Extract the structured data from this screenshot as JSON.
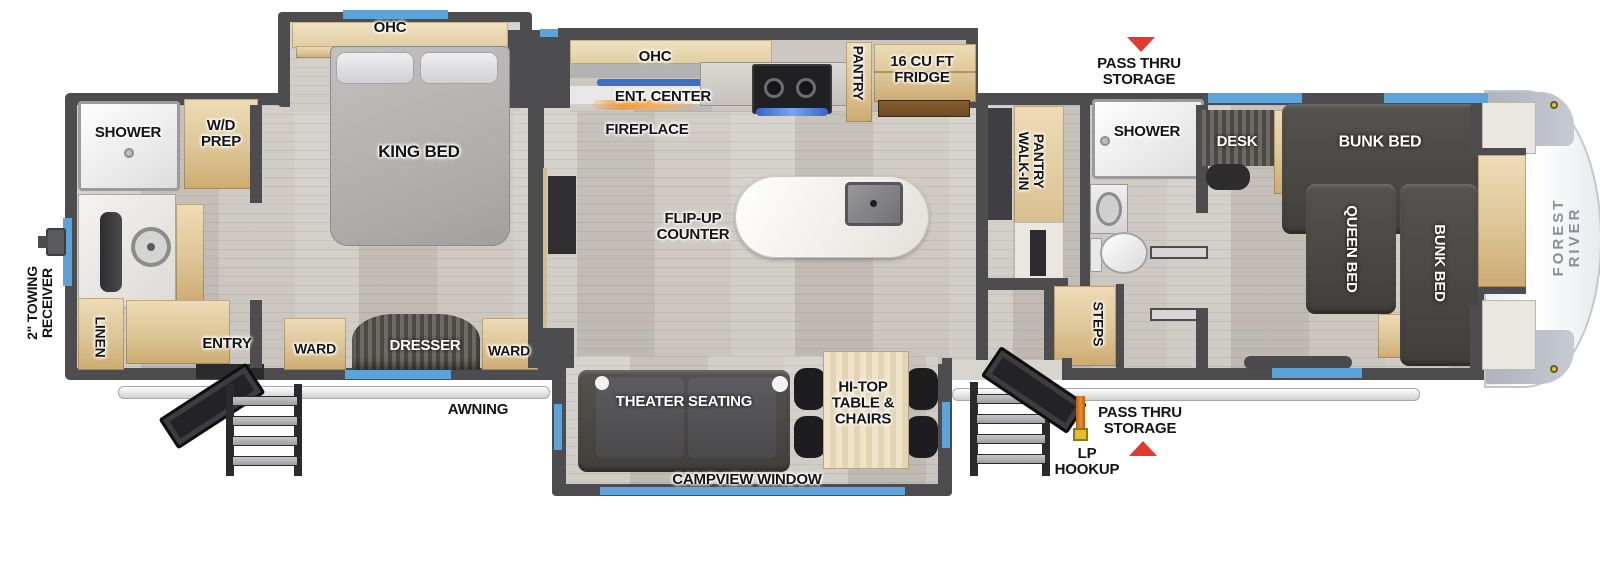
{
  "brand": "FOREST RIVER",
  "labels": {
    "rear_bath": {
      "shower": "SHOWER",
      "wd_prep": "W/D\nPREP",
      "linen": "LINEN",
      "entry": "ENTRY"
    },
    "bedroom": {
      "ohc": "OHC",
      "king_bed": "KING BED",
      "ward_left": "WARD",
      "dresser": "DRESSER",
      "ward_right": "WARD"
    },
    "kitchen": {
      "ohc": "OHC",
      "ent_center": "ENT. CENTER",
      "fireplace": "FIREPLACE",
      "pantry": "PANTRY",
      "fridge": "16 CU FT\nFRIDGE",
      "flip_up": "FLIP-UP\nCOUNTER"
    },
    "living": {
      "theater": "THEATER SEATING",
      "hi_top": "HI-TOP\nTABLE &\nCHAIRS",
      "campview": "CAMPVIEW WINDOW"
    },
    "mid_bath": {
      "walk_in": "WALK-IN\nPANTRY",
      "shower": "SHOWER",
      "steps": "STEPS"
    },
    "bunk_room": {
      "desk": "DESK",
      "bunk_top": "BUNK BED",
      "queen": "QUEEN BED",
      "bunk_side": "BUNK BED"
    },
    "exterior": {
      "towing": "2\" TOWING\nRECEIVER",
      "awning": "AWNING",
      "pass_thru_top": "PASS THRU\nSTORAGE",
      "pass_thru_bottom": "PASS THRU\nSTORAGE",
      "lp_hookup": "LP\nHOOKUP"
    }
  },
  "colors": {
    "wall": "#4d4d4f",
    "window": "#5ba3d9",
    "arrow": "#e23b2e",
    "wood": "#ddc596",
    "dark_furniture": "#4a4846",
    "cap_text": "#899097",
    "lp_hose": "#e0791f"
  }
}
